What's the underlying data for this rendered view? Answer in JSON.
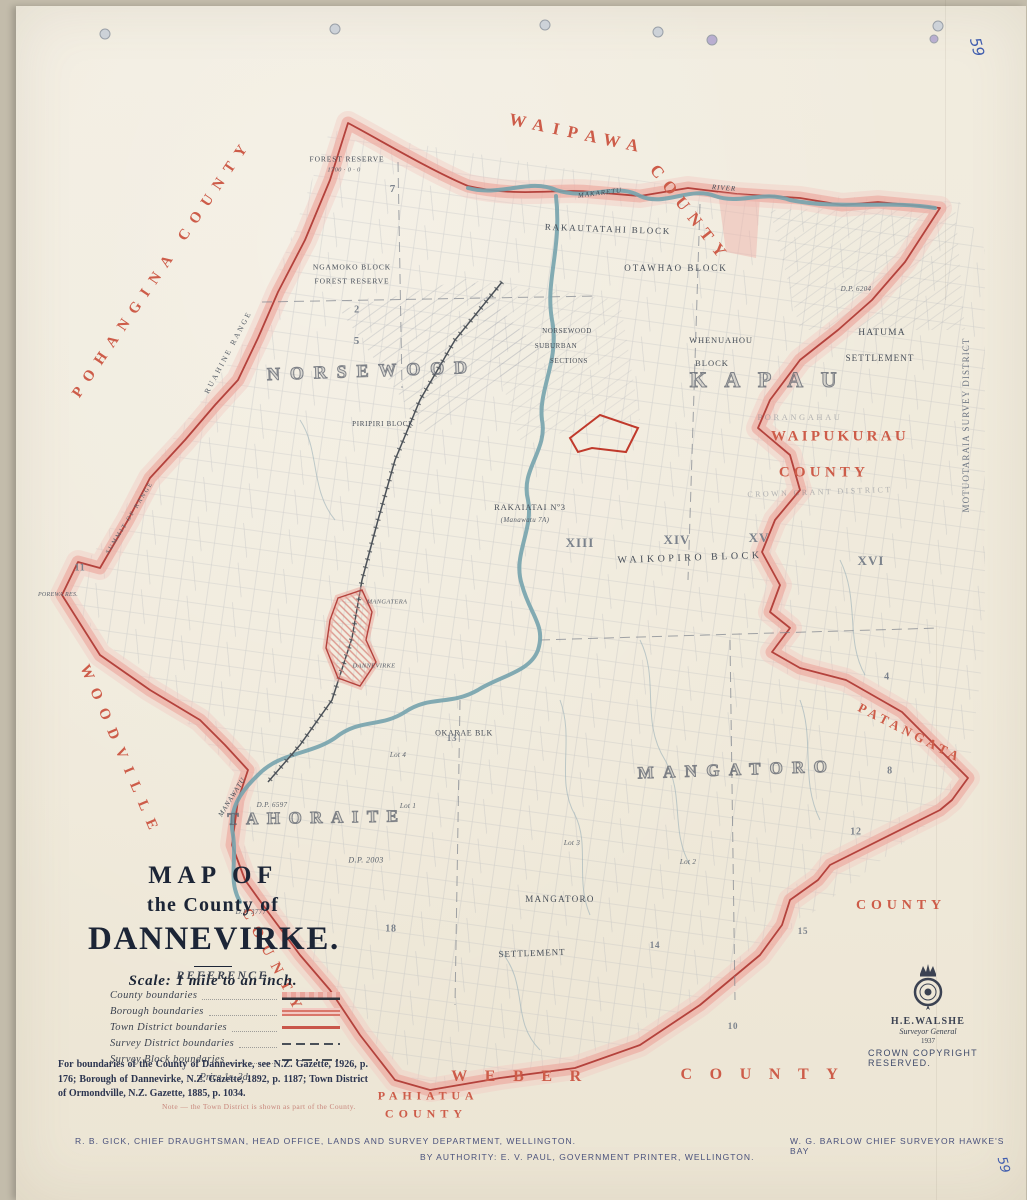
{
  "page": {
    "sheet_number": "59"
  },
  "title_block": {
    "line1": "MAP OF",
    "line2": "the County of",
    "line3": "DANNEVIRKE.",
    "scale": "Scale:  1 mile to an inch."
  },
  "legend": {
    "heading": "REFERENCE.",
    "items": [
      {
        "label": "County boundaries",
        "type": "county"
      },
      {
        "label": "Borough boundaries",
        "type": "borough"
      },
      {
        "label": "Town District boundaries",
        "type": "town"
      },
      {
        "label": "Survey District boundaries",
        "type": "survey-district"
      },
      {
        "label": "Survey Block boundaries",
        "type": "survey-block"
      }
    ],
    "price": "Price 1s. 3d."
  },
  "notes": {
    "gazette": "For boundaries of the County of Dannevirke, see N.Z. Gazette, 1926, p. 176; Borough of Dannevirke, N.Z. Gazette, 1892, p. 1187; Town District of Ormondville, N.Z. Gazette, 1885, p. 1034.",
    "red_note": "Note — the Town District is shown as part of the County."
  },
  "credits": {
    "draughtsman": "R. B. GICK, CHIEF DRAUGHTSMAN, HEAD OFFICE, LANDS AND SURVEY DEPARTMENT, WELLINGTON.",
    "printer": "BY AUTHORITY: E. V. PAUL, GOVERNMENT PRINTER, WELLINGTON.",
    "surveyor": "W. G. BARLOW  CHIEF SURVEYOR  HAWKE'S BAY"
  },
  "seal": {
    "name": "H.E.WALSHE",
    "title": "Surveyor General",
    "year": "1937",
    "copyright": "CROWN COPYRIGHT RESERVED."
  },
  "colors": {
    "boundary_band": "#ecaca3",
    "boundary_line": "#b4423c",
    "county_label_red": "#cd5c49",
    "river_blue": "#76a3ad",
    "paper": "#f0eadb",
    "ink": "#4a5058"
  },
  "map_labels": [
    {
      "t": "WAIPAWA",
      "x": 578,
      "y": 134,
      "s": 17,
      "r": 12,
      "c": "county",
      "ls": 0.5
    },
    {
      "t": "COUNTY",
      "x": 690,
      "y": 214,
      "s": 17,
      "r": 52,
      "c": "county",
      "ls": 0.45
    },
    {
      "t": "POHANGINA  COUNTY",
      "x": 163,
      "y": 268,
      "s": 15,
      "r": -56,
      "c": "county",
      "ls": 0.62
    },
    {
      "t": "WOODVILLE",
      "x": 120,
      "y": 752,
      "s": 15,
      "r": 67,
      "c": "county",
      "ls": 0.68
    },
    {
      "t": "COUNTY",
      "x": 273,
      "y": 963,
      "s": 15,
      "r": 62,
      "c": "county",
      "ls": 0.62
    },
    {
      "t": "WAIPUKURAU",
      "x": 840,
      "y": 437,
      "s": 15,
      "r": 0,
      "c": "county",
      "ls": 0.22
    },
    {
      "t": "COUNTY",
      "x": 824,
      "y": 473,
      "s": 15,
      "r": 0,
      "c": "county",
      "ls": 0.28
    },
    {
      "t": "PATANGATA",
      "x": 910,
      "y": 733,
      "s": 13,
      "r": 27,
      "c": "county",
      "ls": 0.32
    },
    {
      "t": "COUNTY",
      "x": 901,
      "y": 906,
      "s": 14,
      "r": 0,
      "c": "county",
      "ls": 0.35
    },
    {
      "t": "WEBER",
      "x": 525,
      "y": 1077,
      "s": 16,
      "r": 0,
      "c": "county",
      "ls": 1.1
    },
    {
      "t": "COUNTY",
      "x": 768,
      "y": 1075,
      "s": 16,
      "r": 0,
      "c": "county",
      "ls": 1.1
    },
    {
      "t": "PAHIATUA",
      "x": 428,
      "y": 1096,
      "s": 12,
      "r": 0,
      "c": "county",
      "ls": 0.4
    },
    {
      "t": "COUNTY",
      "x": 426,
      "y": 1114,
      "s": 12,
      "r": 0,
      "c": "county",
      "ls": 0.42
    },
    {
      "t": "MOTUOTARAIA  SURVEY  DISTRICT",
      "x": 966,
      "y": 425,
      "s": 9,
      "r": -90,
      "c": "survey",
      "ls": 0.12
    },
    {
      "t": "MAKARETU",
      "x": 600,
      "y": 193,
      "s": 7,
      "r": -7,
      "c": "river"
    },
    {
      "t": "RIVER",
      "x": 724,
      "y": 188,
      "s": 7,
      "r": 4,
      "c": "river"
    },
    {
      "t": "MANAWATU",
      "x": 232,
      "y": 797,
      "s": 7,
      "r": -58,
      "c": "river"
    },
    {
      "t": "FOREST RESERVE",
      "x": 347,
      "y": 159,
      "s": 7.5,
      "r": 0,
      "c": "block",
      "ls": 0.12
    },
    {
      "t": "1700 · 0 · 0",
      "x": 344,
      "y": 170,
      "s": 6.5,
      "r": 0,
      "c": "num"
    },
    {
      "t": "NGAMOKO BLOCK",
      "x": 352,
      "y": 267,
      "s": 7.5,
      "r": 0,
      "c": "block",
      "ls": 0.12
    },
    {
      "t": "FOREST RESERVE",
      "x": 352,
      "y": 281,
      "s": 7.5,
      "r": 0,
      "c": "block",
      "ls": 0.12
    },
    {
      "t": "RAKAUTATAHI  BLOCK",
      "x": 608,
      "y": 229,
      "s": 9,
      "r": 2,
      "c": "block",
      "ls": 0.2
    },
    {
      "t": "OTAWHAO  BLOCK",
      "x": 676,
      "y": 268,
      "s": 9,
      "r": 0,
      "c": "block",
      "ls": 0.22
    },
    {
      "t": "D.P. 6204",
      "x": 856,
      "y": 289,
      "s": 7,
      "r": 0,
      "c": "num"
    },
    {
      "t": "NORSEWOOD",
      "x": 372,
      "y": 371,
      "s": 18,
      "r": -2,
      "c": "outline",
      "ls": 0.55
    },
    {
      "t": "NORSEWOOD",
      "x": 567,
      "y": 331,
      "s": 7,
      "r": 0,
      "c": "block",
      "ls": 0.08
    },
    {
      "t": "SUBURBAN",
      "x": 556,
      "y": 346,
      "s": 7,
      "r": 0,
      "c": "block",
      "ls": 0.08
    },
    {
      "t": "SECTIONS",
      "x": 569,
      "y": 361,
      "s": 7,
      "r": 0,
      "c": "block",
      "ls": 0.08
    },
    {
      "t": "PIRIPIRI BLOCK",
      "x": 383,
      "y": 424,
      "s": 7,
      "r": 0,
      "c": "block",
      "ls": 0.1
    },
    {
      "t": "WHENUAHOU",
      "x": 721,
      "y": 340,
      "s": 8.5,
      "r": 0,
      "c": "block",
      "ls": 0.1
    },
    {
      "t": "BLOCK",
      "x": 712,
      "y": 363,
      "s": 8.5,
      "r": 0,
      "c": "block",
      "ls": 0.12
    },
    {
      "t": "HATUMA",
      "x": 882,
      "y": 333,
      "s": 9.5,
      "r": 0,
      "c": "block",
      "ls": 0.12
    },
    {
      "t": "SETTLEMENT",
      "x": 880,
      "y": 358,
      "s": 9,
      "r": 0,
      "c": "block",
      "ls": 0.12
    },
    {
      "t": "KAPAU",
      "x": 772,
      "y": 380,
      "s": 22,
      "r": 0,
      "c": "outline",
      "ls": 0.8
    },
    {
      "t": "RUAHINE  RANGE",
      "x": 228,
      "y": 352,
      "s": 7.5,
      "r": -62,
      "c": "range"
    },
    {
      "t": "SUMMIT OF RANGE",
      "x": 130,
      "y": 518,
      "s": 6,
      "r": -58,
      "c": "range"
    },
    {
      "t": "POREWA RES.",
      "x": 58,
      "y": 595,
      "s": 6,
      "r": 0,
      "c": "num"
    },
    {
      "t": "RAKAIATAI  Nº3",
      "x": 530,
      "y": 507,
      "s": 8.5,
      "r": 0,
      "c": "block",
      "ls": 0.1
    },
    {
      "t": "(Manawatu 7A)",
      "x": 525,
      "y": 520,
      "s": 7,
      "r": 0,
      "c": "num"
    },
    {
      "t": "WAIKOPIRO  BLOCK",
      "x": 690,
      "y": 558,
      "s": 10,
      "r": -2,
      "c": "block",
      "ls": 0.35
    },
    {
      "t": "XIII",
      "x": 580,
      "y": 543,
      "s": 13,
      "r": 0,
      "c": "roman"
    },
    {
      "t": "XIV",
      "x": 677,
      "y": 540,
      "s": 13,
      "r": 0,
      "c": "roman"
    },
    {
      "t": "XV",
      "x": 759,
      "y": 538,
      "s": 13,
      "r": 0,
      "c": "roman"
    },
    {
      "t": "XVI",
      "x": 871,
      "y": 561,
      "s": 13,
      "r": 0,
      "c": "roman"
    },
    {
      "t": "PORANGAHAU",
      "x": 800,
      "y": 417,
      "s": 8.5,
      "r": 0,
      "c": "faint"
    },
    {
      "t": "CROWN  GRANT  DISTRICT",
      "x": 820,
      "y": 492,
      "s": 8,
      "r": -2,
      "c": "faint"
    },
    {
      "t": "MANGATERA",
      "x": 387,
      "y": 602,
      "s": 6.5,
      "r": 0,
      "c": "num"
    },
    {
      "t": "DANNEVIRKE",
      "x": 374,
      "y": 666,
      "s": 6.5,
      "r": 0,
      "c": "num"
    },
    {
      "t": "OKARAE BLK",
      "x": 464,
      "y": 733,
      "s": 8,
      "r": 0,
      "c": "block",
      "ls": 0.08
    },
    {
      "t": "TAHORAITE",
      "x": 317,
      "y": 818,
      "s": 17,
      "r": -1,
      "c": "outline",
      "ls": 0.5
    },
    {
      "t": "MANGATORO",
      "x": 737,
      "y": 770,
      "s": 17,
      "r": -2,
      "c": "outline",
      "ls": 0.55
    },
    {
      "t": "MANGATORO",
      "x": 560,
      "y": 899,
      "s": 9,
      "r": 0,
      "c": "block",
      "ls": 0.15
    },
    {
      "t": "SETTLEMENT",
      "x": 532,
      "y": 953,
      "s": 9,
      "r": -2,
      "c": "block",
      "ls": 0.1
    },
    {
      "t": "D.P. 6597",
      "x": 272,
      "y": 805,
      "s": 7,
      "r": 0,
      "c": "num"
    },
    {
      "t": "D.P. 3777",
      "x": 251,
      "y": 912,
      "s": 7,
      "r": 0,
      "c": "num"
    },
    {
      "t": "D.P. 2003",
      "x": 366,
      "y": 860,
      "s": 8,
      "r": 0,
      "c": "num"
    },
    {
      "t": "Lot 1",
      "x": 408,
      "y": 806,
      "s": 7,
      "r": 0,
      "c": "num"
    },
    {
      "t": "Lot 4",
      "x": 398,
      "y": 755,
      "s": 7,
      "r": 0,
      "c": "num"
    },
    {
      "t": "Lot 3",
      "x": 572,
      "y": 843,
      "s": 7,
      "r": 0,
      "c": "num"
    },
    {
      "t": "Lot 2",
      "x": 688,
      "y": 862,
      "s": 7,
      "r": 0,
      "c": "num"
    },
    {
      "t": "7",
      "x": 393,
      "y": 189,
      "s": 11,
      "r": 0,
      "c": "roman"
    },
    {
      "t": "5",
      "x": 357,
      "y": 341,
      "s": 11,
      "r": 0,
      "c": "roman"
    },
    {
      "t": "2",
      "x": 357,
      "y": 310,
      "s": 10,
      "r": 0,
      "c": "roman"
    },
    {
      "t": "11",
      "x": 80,
      "y": 568,
      "s": 10,
      "r": 0,
      "c": "roman"
    },
    {
      "t": "13",
      "x": 452,
      "y": 738,
      "s": 9,
      "r": 0,
      "c": "roman"
    },
    {
      "t": "18",
      "x": 391,
      "y": 929,
      "s": 10,
      "r": 0,
      "c": "roman"
    },
    {
      "t": "12",
      "x": 856,
      "y": 832,
      "s": 10,
      "r": 0,
      "c": "roman"
    },
    {
      "t": "15",
      "x": 803,
      "y": 931,
      "s": 9,
      "r": 0,
      "c": "roman"
    },
    {
      "t": "10",
      "x": 733,
      "y": 1026,
      "s": 9,
      "r": 0,
      "c": "roman"
    },
    {
      "t": "14",
      "x": 655,
      "y": 945,
      "s": 9,
      "r": 0,
      "c": "roman"
    },
    {
      "t": "4",
      "x": 887,
      "y": 677,
      "s": 10,
      "r": 0,
      "c": "roman"
    },
    {
      "t": "8",
      "x": 890,
      "y": 771,
      "s": 10,
      "r": 0,
      "c": "roman"
    },
    {
      "t": "59",
      "x": 977,
      "y": 47,
      "s": 15,
      "r": 75,
      "c": "hand"
    },
    {
      "t": "59",
      "x": 1003,
      "y": 1165,
      "s": 13,
      "r": 75,
      "c": "hand"
    }
  ]
}
